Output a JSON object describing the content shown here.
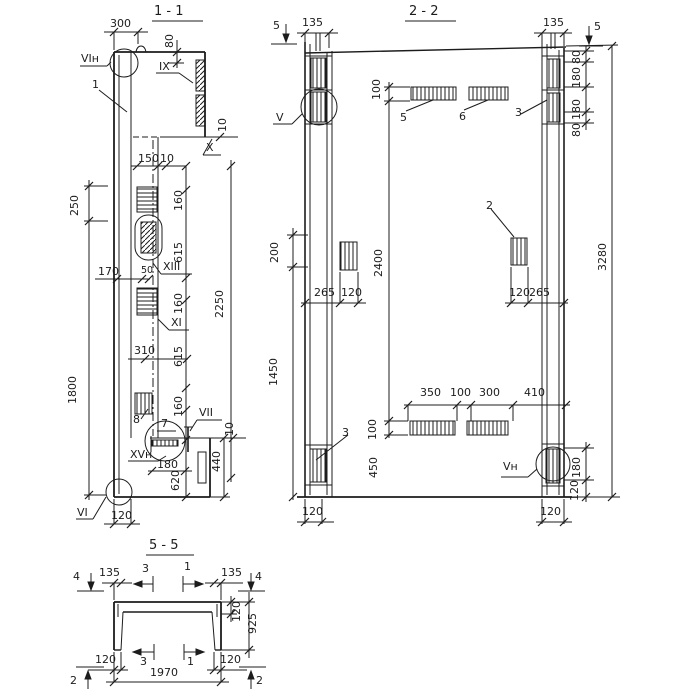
{
  "canvas": {
    "width": 700,
    "height": 700,
    "background": "#ffffff",
    "ink": "#1c1c1c"
  },
  "drawing": {
    "kind": "reinforced concrete panel sections",
    "section_titles": [
      "1 - 1",
      "2 - 2",
      "5 - 5"
    ]
  },
  "labels": [
    {
      "name": "section-title-1-1",
      "text": "1 - 1",
      "x": 154,
      "y": 5,
      "cls": "title"
    },
    {
      "name": "dim-label",
      "text": "300",
      "x": 110,
      "y": 18
    },
    {
      "name": "dim-label",
      "text": "80",
      "x": 164,
      "y": 48,
      "rot": 1
    },
    {
      "name": "detail-ref-label",
      "text": "VIн",
      "x": 81,
      "y": 53
    },
    {
      "name": "part-ref-label",
      "text": "1",
      "x": 92,
      "y": 79
    },
    {
      "name": "detail-ref-label",
      "text": "IX",
      "x": 159,
      "y": 61
    },
    {
      "name": "dim-label",
      "text": "10",
      "x": 217,
      "y": 132,
      "rot": 1
    },
    {
      "name": "detail-ref-label",
      "text": "X",
      "x": 206,
      "y": 142
    },
    {
      "name": "dim-label",
      "text": "150",
      "x": 138,
      "y": 153
    },
    {
      "name": "dim-label",
      "text": "10",
      "x": 160,
      "y": 153
    },
    {
      "name": "dim-label",
      "text": "160",
      "x": 173,
      "y": 211,
      "rot": 1
    },
    {
      "name": "dim-label",
      "text": "615",
      "x": 173,
      "y": 263,
      "rot": 1
    },
    {
      "name": "dim-label",
      "text": "2250",
      "x": 214,
      "y": 318,
      "rot": 1
    },
    {
      "name": "dim-label",
      "text": "160",
      "x": 173,
      "y": 314,
      "rot": 1
    },
    {
      "name": "dim-label",
      "text": "615",
      "x": 173,
      "y": 367,
      "rot": 1
    },
    {
      "name": "dim-label",
      "text": "160",
      "x": 173,
      "y": 417,
      "rot": 1
    },
    {
      "name": "dim-label",
      "text": "250",
      "x": 69,
      "y": 216,
      "rot": 1
    },
    {
      "name": "dim-label",
      "text": "1800",
      "x": 67,
      "y": 404,
      "rot": 1
    },
    {
      "name": "dim-label",
      "text": "170",
      "x": 98,
      "y": 266
    },
    {
      "name": "dim-label",
      "text": "50",
      "x": 141,
      "y": 266,
      "cls": "small"
    },
    {
      "name": "detail-ref-label",
      "text": "XIII",
      "x": 163,
      "y": 261
    },
    {
      "name": "detail-ref-label",
      "text": "XI",
      "x": 171,
      "y": 317
    },
    {
      "name": "dim-label",
      "text": "310",
      "x": 134,
      "y": 345
    },
    {
      "name": "part-ref-label",
      "text": "8",
      "x": 133,
      "y": 414
    },
    {
      "name": "part-ref-label",
      "text": "7",
      "x": 161,
      "y": 418
    },
    {
      "name": "detail-ref-label",
      "text": "VII",
      "x": 199,
      "y": 407
    },
    {
      "name": "dim-label",
      "text": "10",
      "x": 224,
      "y": 436,
      "rot": 1
    },
    {
      "name": "detail-ref-label",
      "text": "XVн",
      "x": 130,
      "y": 449
    },
    {
      "name": "dim-label",
      "text": "180",
      "x": 157,
      "y": 459
    },
    {
      "name": "dim-label",
      "text": "620",
      "x": 170,
      "y": 491,
      "rot": 1
    },
    {
      "name": "dim-label",
      "text": "440",
      "x": 211,
      "y": 472,
      "rot": 1
    },
    {
      "name": "detail-ref-label",
      "text": "VI",
      "x": 77,
      "y": 507
    },
    {
      "name": "dim-label",
      "text": "120",
      "x": 111,
      "y": 510
    },
    {
      "name": "section-title-2-2",
      "text": "2 - 2",
      "x": 409,
      "y": 5,
      "cls": "title"
    },
    {
      "name": "section-marker-label",
      "text": "5",
      "x": 273,
      "y": 20
    },
    {
      "name": "dim-label",
      "text": "135",
      "x": 302,
      "y": 17
    },
    {
      "name": "dim-label",
      "text": "135",
      "x": 543,
      "y": 17
    },
    {
      "name": "section-marker-label",
      "text": "5",
      "x": 594,
      "y": 21
    },
    {
      "name": "dim-label",
      "text": "80",
      "x": 571,
      "y": 64,
      "rot": 1
    },
    {
      "name": "dim-label",
      "text": "180",
      "x": 571,
      "y": 88,
      "rot": 1
    },
    {
      "name": "dim-label",
      "text": "180",
      "x": 571,
      "y": 120,
      "rot": 1
    },
    {
      "name": "dim-label",
      "text": "80",
      "x": 571,
      "y": 137,
      "rot": 1
    },
    {
      "name": "detail-ref-label",
      "text": "V",
      "x": 276,
      "y": 112
    },
    {
      "name": "dim-label",
      "text": "100",
      "x": 371,
      "y": 100,
      "rot": 1
    },
    {
      "name": "part-ref-label",
      "text": "5",
      "x": 400,
      "y": 112
    },
    {
      "name": "part-ref-label",
      "text": "6",
      "x": 459,
      "y": 111
    },
    {
      "name": "part-ref-label",
      "text": "3",
      "x": 515,
      "y": 107
    },
    {
      "name": "part-ref-label",
      "text": "2",
      "x": 486,
      "y": 200
    },
    {
      "name": "dim-label",
      "text": "200",
      "x": 269,
      "y": 263,
      "rot": 1
    },
    {
      "name": "dim-label",
      "text": "2400",
      "x": 373,
      "y": 277,
      "rot": 1
    },
    {
      "name": "dim-label",
      "text": "3280",
      "x": 597,
      "y": 271,
      "rot": 1
    },
    {
      "name": "dim-label",
      "text": "265",
      "x": 314,
      "y": 287
    },
    {
      "name": "dim-label",
      "text": "120",
      "x": 341,
      "y": 287
    },
    {
      "name": "dim-label",
      "text": "120",
      "x": 509,
      "y": 287
    },
    {
      "name": "dim-label",
      "text": "265",
      "x": 529,
      "y": 287
    },
    {
      "name": "dim-label",
      "text": "1450",
      "x": 268,
      "y": 386,
      "rot": 1
    },
    {
      "name": "dim-label",
      "text": "350",
      "x": 420,
      "y": 387
    },
    {
      "name": "dim-label",
      "text": "100",
      "x": 450,
      "y": 387
    },
    {
      "name": "dim-label",
      "text": "300",
      "x": 479,
      "y": 387
    },
    {
      "name": "dim-label",
      "text": "410",
      "x": 524,
      "y": 387
    },
    {
      "name": "dim-label",
      "text": "100",
      "x": 367,
      "y": 440,
      "rot": 1
    },
    {
      "name": "dim-label",
      "text": "450",
      "x": 368,
      "y": 478,
      "rot": 1
    },
    {
      "name": "part-ref-label",
      "text": "3",
      "x": 342,
      "y": 427
    },
    {
      "name": "detail-ref-label",
      "text": "Vн",
      "x": 503,
      "y": 461
    },
    {
      "name": "dim-label",
      "text": "180",
      "x": 571,
      "y": 478,
      "rot": 1
    },
    {
      "name": "dim-label",
      "text": "120",
      "x": 569,
      "y": 501,
      "rot": 1
    },
    {
      "name": "dim-label",
      "text": "120",
      "x": 302,
      "y": 506
    },
    {
      "name": "dim-label",
      "text": "120",
      "x": 540,
      "y": 506
    },
    {
      "name": "section-title-5-5",
      "text": "5 - 5",
      "x": 149,
      "y": 539,
      "cls": "title"
    },
    {
      "name": "section-marker-label",
      "text": "4",
      "x": 73,
      "y": 571
    },
    {
      "name": "dim-label",
      "text": "135",
      "x": 99,
      "y": 567
    },
    {
      "name": "section-marker-label",
      "text": "3",
      "x": 142,
      "y": 563
    },
    {
      "name": "section-marker-label",
      "text": "1",
      "x": 184,
      "y": 561
    },
    {
      "name": "dim-label",
      "text": "135",
      "x": 221,
      "y": 567
    },
    {
      "name": "section-marker-label",
      "text": "4",
      "x": 255,
      "y": 571
    },
    {
      "name": "dim-label",
      "text": "120",
      "x": 231,
      "y": 622,
      "rot": 1
    },
    {
      "name": "dim-label",
      "text": "925",
      "x": 247,
      "y": 634,
      "rot": 1
    },
    {
      "name": "dim-label",
      "text": "120",
      "x": 95,
      "y": 654
    },
    {
      "name": "section-marker-label",
      "text": "3",
      "x": 140,
      "y": 656
    },
    {
      "name": "section-marker-label",
      "text": "1",
      "x": 187,
      "y": 656
    },
    {
      "name": "dim-label",
      "text": "120",
      "x": 220,
      "y": 654
    },
    {
      "name": "dim-label",
      "text": "1970",
      "x": 150,
      "y": 667
    },
    {
      "name": "section-marker-label",
      "text": "2",
      "x": 70,
      "y": 675
    },
    {
      "name": "section-marker-label",
      "text": "2",
      "x": 256,
      "y": 675
    }
  ]
}
